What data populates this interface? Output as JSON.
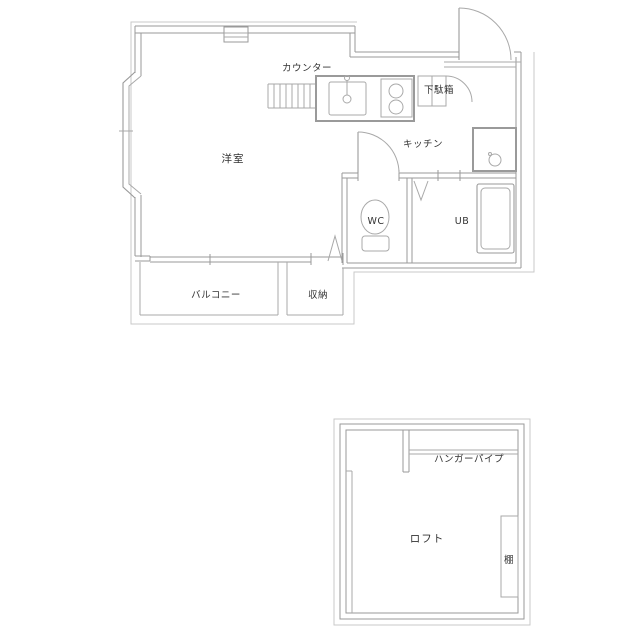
{
  "colors": {
    "background": "#ffffff",
    "wall_line": "#9a9a9a",
    "thin_line": "#c9c9c9",
    "fixture_line": "#a9a9a9",
    "text": "#333333"
  },
  "main_floor": {
    "labels": {
      "counter": "カウンター",
      "shoe_cabinet": "下駄箱",
      "western_room": "洋室",
      "kitchen": "キッチン",
      "toilet": "WC",
      "unit_bath": "UB",
      "balcony": "バルコニー",
      "storage": "収納"
    }
  },
  "loft_floor": {
    "labels": {
      "hanger_pipe": "ハンガーパイプ",
      "loft": "ロフト",
      "shelf": "棚"
    }
  }
}
